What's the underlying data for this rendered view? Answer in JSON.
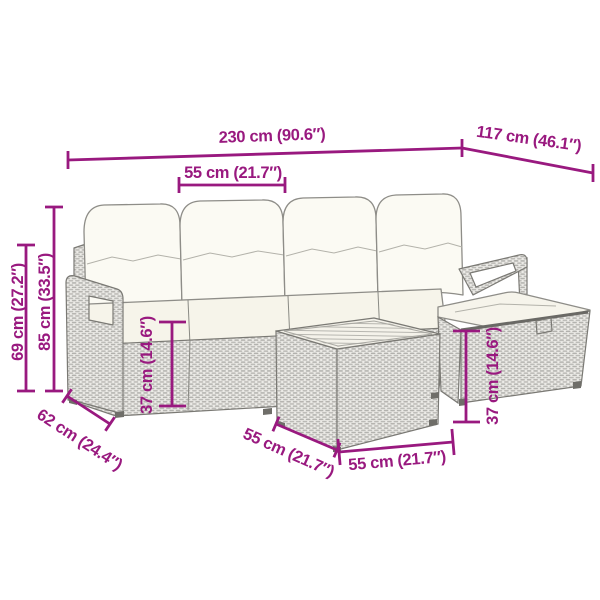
{
  "title": "garden furniture set dimension diagram",
  "accent_color": "#99197f",
  "background": "#ffffff",
  "dims": {
    "total_width": "230 cm (90.6″)",
    "total_depth": "117 cm (46.1″)",
    "seat_width": "55 cm (21.7″)",
    "backrest_height": "85 cm (33.5″)",
    "armrest_height": "69 cm (27.2″)",
    "seat_height": "37 cm (14.6″)",
    "footstool_height": "37 cm (14.6″)",
    "sofa_depth": "62 cm (24.4″)",
    "table_depth": "55 cm (21.7″)",
    "table_width": "55 cm (21.7″)"
  },
  "parts": {
    "sofa": "four-seat-rattan-sofa",
    "footstool": "rattan-footstool",
    "table": "rattan-coffee-table"
  }
}
